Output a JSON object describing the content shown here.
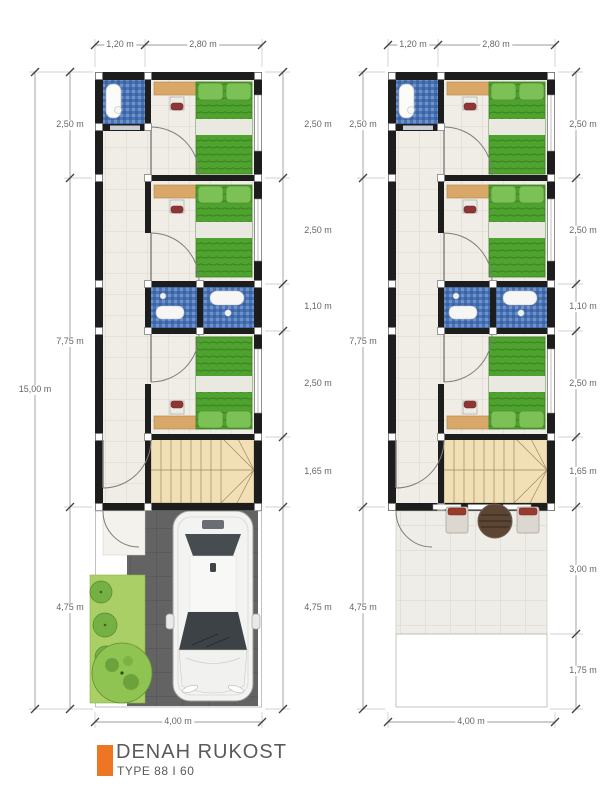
{
  "title": {
    "name": "DENAH RUKOST",
    "type": "TYPE 88 I 60"
  },
  "floors": [
    {
      "label": "ground-floor",
      "top": [
        "1,20 m",
        "2,80 m"
      ],
      "left_overall": "15,00 m",
      "left": [
        "2,50 m",
        "7,75 m",
        "4,75 m"
      ],
      "right": [
        "2,50 m",
        "2,50 m",
        "1,10 m",
        "2,50 m",
        "1,65 m",
        "4,75 m"
      ],
      "bottom": "4,00 m"
    },
    {
      "label": "upper-floor",
      "top": [
        "1,20 m",
        "2,80 m"
      ],
      "left": [
        "2,50 m",
        "7,75 m",
        "4,75 m"
      ],
      "right": [
        "2,50 m",
        "2,50 m",
        "1,10 m",
        "2,50 m",
        "1,65 m",
        "3,00 m",
        "1,75 m"
      ],
      "bottom": "4,00 m"
    }
  ],
  "colors": {
    "accent_orange": "#ee7623",
    "wall_black": "#1d1d1d",
    "bed_green": "#4ea32e",
    "bath_tile_blue": "#4a73b4",
    "desk_wood": "#d9a868",
    "stair_wood": "#f1dfb6",
    "pavement_gray": "#636363",
    "grass_green": "#aacf66",
    "dim_text_gray": "#666666"
  }
}
